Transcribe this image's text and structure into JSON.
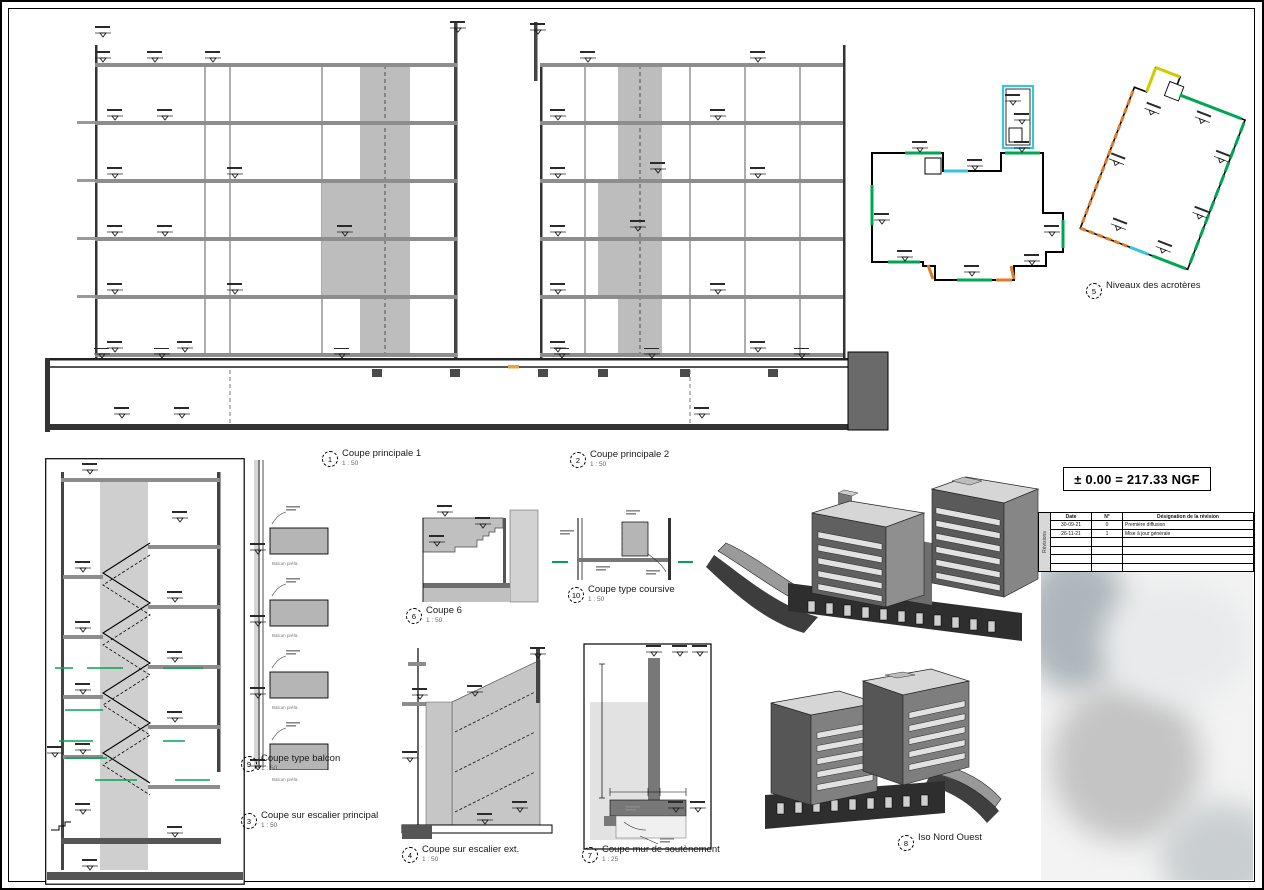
{
  "sheet": {
    "datum_label": "± 0.00 = 217.33 NGF"
  },
  "view_titles": {
    "coupe1": {
      "num": "1",
      "title": "Coupe principale 1",
      "scale": "1 : 50"
    },
    "coupe2": {
      "num": "2",
      "title": "Coupe principale 2",
      "scale": "1 : 50"
    },
    "acroteres": {
      "num": "5",
      "title": "Niveaux des acrotères",
      "scale": ""
    },
    "coupe6": {
      "num": "6",
      "title": "Coupe 6",
      "scale": "1 : 50"
    },
    "coursive": {
      "num": "10",
      "title": "Coupe type coursive",
      "scale": "1 : 50"
    },
    "balcon": {
      "num": "9",
      "title": "Coupe type balcon",
      "scale": "1 : 50"
    },
    "escalier_principal": {
      "num": "3",
      "title": "Coupe sur escalier principal",
      "scale": "1 : 50"
    },
    "escalier_ext": {
      "num": "4",
      "title": "Coupe sur escalier ext.",
      "scale": "1 : 50"
    },
    "soutenement": {
      "num": "7",
      "title": "Coupe mur de soutènement",
      "scale": "1 : 25"
    },
    "iso": {
      "num": "8",
      "title": "Iso Nord Ouest",
      "scale": ""
    }
  },
  "balcony_label": "Balcon préfa.",
  "revision_table": {
    "side_label": "Révisions",
    "headers": {
      "date": "Date",
      "num": "N°",
      "designation": "Désignation de la révision"
    },
    "rows": [
      {
        "date": "30-09-21",
        "num": "0",
        "designation": "Première diffusion"
      },
      {
        "date": "26-11-21",
        "num": "1",
        "designation": "Mise à jour générale"
      }
    ]
  },
  "colors": {
    "line": "#000000",
    "slab_gray": "#9a9a9a",
    "core_gray": "#bdbdbd",
    "dark_gray": "#555555",
    "green": "#00a651",
    "orange": "#e07b28",
    "cyan": "#37c4dc",
    "yellow": "#d2ca00"
  }
}
